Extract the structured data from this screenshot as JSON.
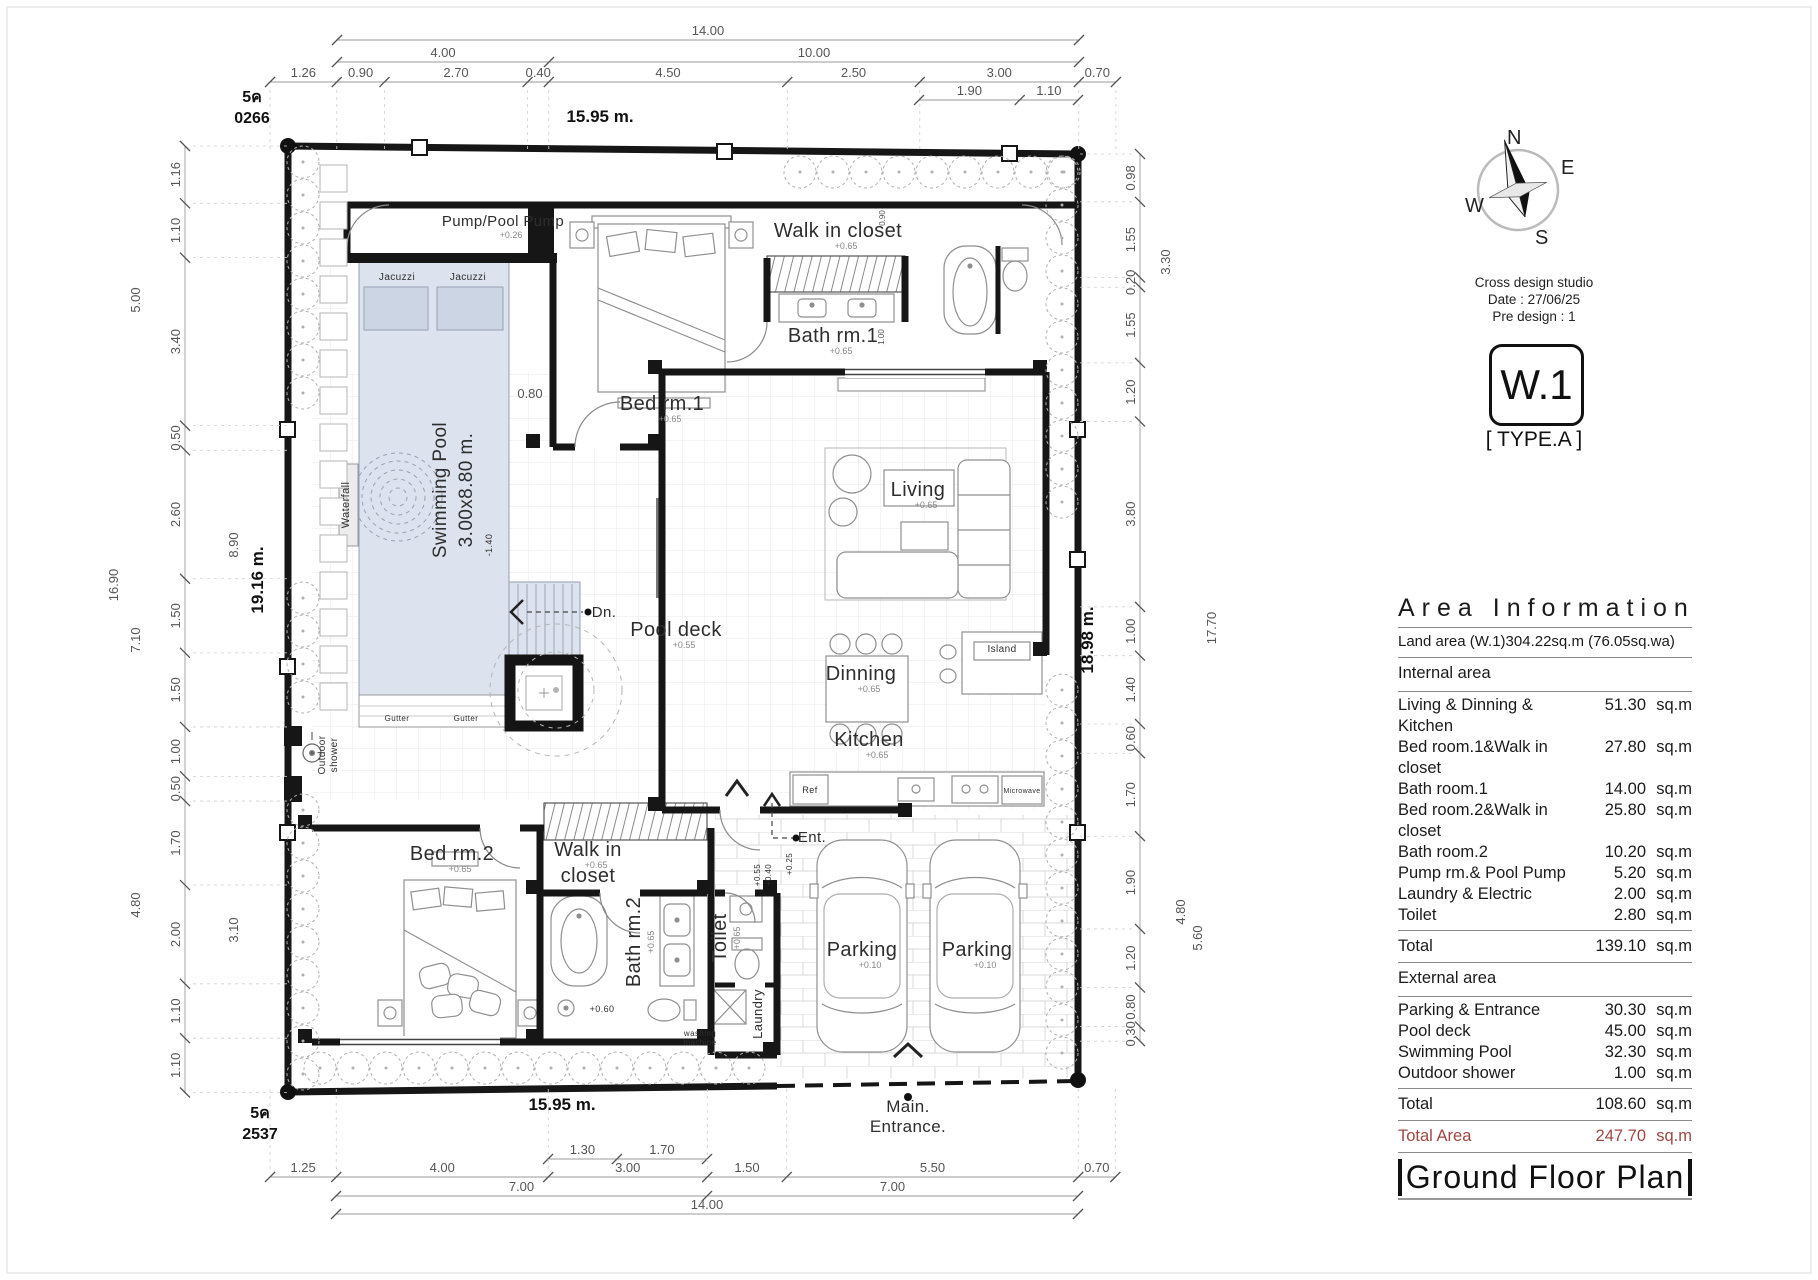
{
  "compass": {
    "n": "N",
    "e": "E",
    "s": "S",
    "w": "W"
  },
  "title_block": {
    "studio": "Cross design studio",
    "date_line": "Date : 27/06/25",
    "predesign_line": "Pre design : 1",
    "code": "W.1",
    "type_label": "[ TYPE.A ]"
  },
  "area_info": {
    "title": "Area Information",
    "land_line": "Land area (W.1)304.22sq.m (76.05sq.wa)",
    "internal_header": "Internal area",
    "internal_rows": [
      {
        "label": "Living & Dinning & Kitchen",
        "value": "51.30",
        "unit": "sq.m"
      },
      {
        "label": "Bed room.1&Walk in closet",
        "value": "27.80",
        "unit": "sq.m"
      },
      {
        "label": "Bath room.1",
        "value": "14.00",
        "unit": "sq.m"
      },
      {
        "label": "Bed room.2&Walk in closet",
        "value": "25.80",
        "unit": "sq.m"
      },
      {
        "label": "Bath room.2",
        "value": "10.20",
        "unit": "sq.m"
      },
      {
        "label": "Pump rm.& Pool Pump",
        "value": "5.20",
        "unit": "sq.m"
      },
      {
        "label": "Laundry & Electric",
        "value": "2.00",
        "unit": "sq.m"
      },
      {
        "label": "Toilet",
        "value": "2.80",
        "unit": "sq.m"
      }
    ],
    "internal_total": {
      "label": "Total",
      "value": "139.10",
      "unit": "sq.m"
    },
    "external_header": "External area",
    "external_rows": [
      {
        "label": "Parking & Entrance",
        "value": "30.30",
        "unit": "sq.m"
      },
      {
        "label": "Pool deck",
        "value": "45.00",
        "unit": "sq.m"
      },
      {
        "label": "Swimming Pool",
        "value": "32.30",
        "unit": "sq.m"
      },
      {
        "label": "Outdoor shower",
        "value": "1.00",
        "unit": "sq.m"
      }
    ],
    "external_total": {
      "label": "Total",
      "value": "108.60",
      "unit": "sq.m"
    },
    "grand_total": {
      "label": "Total Area",
      "value": "247.70",
      "unit": "sq.m"
    },
    "accent_color": "#9c4742",
    "plan_title": "Ground Floor Plan"
  },
  "plan": {
    "boundary_labels": [
      {
        "t": "15.95 m.",
        "x": 600,
        "y": 122
      },
      {
        "t": "15.95 m.",
        "x": 562,
        "y": 1110
      },
      {
        "t": "19.16 m.",
        "x": 263,
        "y": 580,
        "r": -90
      },
      {
        "t": "18.98 m.",
        "x": 1093,
        "y": 640,
        "r": -90
      }
    ],
    "corner_markers": [
      {
        "l1": "5ค",
        "l2": "0266",
        "x": 252,
        "y": 102
      },
      {
        "l1": "5ค",
        "l2": "2537",
        "x": 260,
        "y": 1118
      }
    ],
    "chains": {
      "sx": 53,
      "syl": 49.4,
      "syr": 48.8,
      "h": [
        {
          "y": 40,
          "x0": 337,
          "v": [
            "14.00"
          ]
        },
        {
          "y": 62,
          "x0": 337,
          "v": [
            "4.00",
            "10.00"
          ]
        },
        {
          "y": 82,
          "x0": 270,
          "v": [
            "1.26",
            "0.90",
            "2.70",
            "0.40",
            "4.50",
            "2.50",
            "3.00",
            "0.70"
          ],
          "ext": 150
        },
        {
          "y": 100,
          "x0": 919,
          "v": [
            "1.90",
            "1.10"
          ]
        },
        {
          "y": 1159,
          "x0": 548,
          "v": [
            "1.30",
            "1.70"
          ]
        },
        {
          "y": 1177,
          "x0": 270,
          "v": [
            "1.25",
            "4.00",
            "3.00",
            "1.50",
            "5.50",
            "0.70"
          ],
          "ext": 1085
        },
        {
          "y": 1196,
          "x0": 336,
          "v": [
            "7.00",
            "7.00"
          ]
        },
        {
          "y": 1214,
          "x0": 336,
          "v": [
            "14.00"
          ]
        }
      ],
      "vl": [
        {
          "x": 185,
          "y0": 146,
          "v": [
            "1.16",
            "1.10",
            "3.40",
            "0.50",
            "2.60",
            "1.50",
            "1.50",
            "1.00",
            "0.50",
            "1.70",
            "2.00",
            "1.10",
            "1.10"
          ],
          "ext": 288
        }
      ],
      "vr": [
        {
          "x": 1140,
          "y0": 154,
          "v": [
            "0.98",
            "1.55",
            "0.20",
            "1.55",
            "1.20",
            "3.80",
            "1.00",
            "1.40",
            "0.60",
            "1.70",
            "1.90",
            "1.20",
            "0.80",
            "0.30"
          ],
          "ext": 1078
        }
      ]
    },
    "extra_dims": [
      {
        "t": "5.00",
        "x": 140,
        "y": 300,
        "r": -90
      },
      {
        "t": "16.90",
        "x": 118,
        "y": 585,
        "r": -90
      },
      {
        "t": "7.10",
        "x": 140,
        "y": 640,
        "r": -90
      },
      {
        "t": "8.90",
        "x": 238,
        "y": 545,
        "r": -90
      },
      {
        "t": "4.80",
        "x": 140,
        "y": 905,
        "r": -90
      },
      {
        "t": "3.10",
        "x": 238,
        "y": 930,
        "r": -90
      },
      {
        "t": "17.70",
        "x": 1216,
        "y": 628,
        "r": -90
      },
      {
        "t": "3.30",
        "x": 1170,
        "y": 262,
        "r": -90
      },
      {
        "t": "4.80",
        "x": 1185,
        "y": 912,
        "r": -90
      },
      {
        "t": "5.60",
        "x": 1202,
        "y": 938,
        "r": -90
      },
      {
        "t": "0.80",
        "x": 530,
        "y": 398
      },
      {
        "t": "0.90",
        "x": 885,
        "y": 218,
        "r": -90,
        "s": 8
      },
      {
        "t": "1.00",
        "x": 884,
        "y": 337,
        "r": -90,
        "s": 8
      }
    ],
    "rooms": [
      {
        "t": "Pump/Pool Pump",
        "x": 503,
        "y": 226,
        "s": 15,
        "sub": "+0.26"
      },
      {
        "t": "Jacuzzi",
        "x": 397,
        "y": 280,
        "s": 10
      },
      {
        "t": "Jacuzzi",
        "x": 468,
        "y": 280,
        "s": 10
      },
      {
        "t": "Swimming Pool",
        "x": 446,
        "y": 490,
        "s": 19,
        "r": -90
      },
      {
        "t": "3.00x8.80 m.",
        "x": 472,
        "y": 490,
        "s": 19,
        "r": -90
      },
      {
        "t": "-1.40",
        "x": 492,
        "y": 545,
        "s": 9,
        "r": -90
      },
      {
        "t": "Waterfall",
        "x": 349,
        "y": 505,
        "s": 11,
        "r": -90
      },
      {
        "t": "Bed rm.1",
        "x": 662,
        "y": 410,
        "s": 20,
        "sub": "+0.65"
      },
      {
        "t": "Walk in closet",
        "x": 838,
        "y": 237,
        "s": 20,
        "sub": "+0.65"
      },
      {
        "t": "Bath rm.1",
        "x": 833,
        "y": 342,
        "s": 20,
        "sub": "+0.65"
      },
      {
        "t": "Living",
        "x": 918,
        "y": 496,
        "s": 20,
        "sub": "+0.65"
      },
      {
        "t": "Dinning",
        "x": 861,
        "y": 680,
        "s": 20,
        "sub": "+0.65"
      },
      {
        "t": "Kitchen",
        "x": 869,
        "y": 746,
        "s": 20,
        "sub": "+0.65"
      },
      {
        "t": "Island",
        "x": 1002,
        "y": 652,
        "s": 10
      },
      {
        "t": "Pool deck",
        "x": 676,
        "y": 636,
        "s": 20,
        "sub": "+0.55"
      },
      {
        "t": "Dn.",
        "x": 604,
        "y": 617,
        "s": 15
      },
      {
        "t": "Bed rm.2",
        "x": 452,
        "y": 860,
        "s": 20,
        "sub": "+0.65"
      },
      {
        "t": "Walk in",
        "x": 588,
        "y": 856,
        "s": 20,
        "sub": "+0.65"
      },
      {
        "t": "closet",
        "x": 588,
        "y": 882,
        "s": 20
      },
      {
        "t": "Bath rm.2",
        "x": 640,
        "y": 942,
        "s": 20,
        "r": -90,
        "sub": "+0.65"
      },
      {
        "t": "Toilet",
        "x": 726,
        "y": 938,
        "s": 20,
        "r": -90,
        "sub": "+0.65"
      },
      {
        "t": "Laundry",
        "x": 762,
        "y": 1014,
        "s": 13,
        "r": -90
      },
      {
        "t": "washing",
        "x": 700,
        "y": 1036,
        "s": 8
      },
      {
        "t": "machine",
        "x": 700,
        "y": 1045,
        "s": 8
      },
      {
        "t": "Parking",
        "x": 862,
        "y": 956,
        "s": 20,
        "sub": "+0.10"
      },
      {
        "t": "Parking",
        "x": 977,
        "y": 956,
        "s": 20,
        "sub": "+0.10"
      },
      {
        "t": "Ent.",
        "x": 812,
        "y": 842,
        "s": 15
      },
      {
        "t": "+0.25",
        "x": 792,
        "y": 864,
        "s": 8,
        "r": -90
      },
      {
        "t": "+0.55",
        "x": 760,
        "y": 875,
        "s": 8,
        "r": -90
      },
      {
        "t": "+0.40",
        "x": 771,
        "y": 875,
        "s": 8,
        "r": -90
      },
      {
        "t": "Main.",
        "x": 908,
        "y": 1112,
        "s": 17
      },
      {
        "t": "Entrance.",
        "x": 908,
        "y": 1132,
        "s": 17
      },
      {
        "t": "Gutter",
        "x": 397,
        "y": 721,
        "s": 8
      },
      {
        "t": "Gutter",
        "x": 466,
        "y": 721,
        "s": 8
      },
      {
        "t": "Outdoor",
        "x": 325,
        "y": 755,
        "s": 10,
        "r": -90
      },
      {
        "t": "shower",
        "x": 337,
        "y": 755,
        "s": 10,
        "r": -90
      },
      {
        "t": "+0.60",
        "x": 602,
        "y": 1012,
        "s": 9
      },
      {
        "t": "Ref",
        "x": 810,
        "y": 793,
        "s": 9
      },
      {
        "t": "Microwave",
        "x": 1022,
        "y": 793,
        "s": 7
      }
    ],
    "tree_runs": [
      {
        "axis": "x",
        "fixed": 172,
        "from": 800,
        "to": 1064,
        "step": 33
      },
      {
        "axis": "x",
        "fixed": 1068,
        "from": 320,
        "to": 752,
        "step": 33
      },
      {
        "axis": "y",
        "fixed": 303,
        "from": 162,
        "to": 395,
        "step": 33
      },
      {
        "axis": "y",
        "fixed": 303,
        "from": 598,
        "to": 698,
        "step": 33
      },
      {
        "axis": "y",
        "fixed": 303,
        "from": 810,
        "to": 1075,
        "step": 33
      },
      {
        "axis": "y",
        "fixed": 1062,
        "from": 172,
        "to": 503,
        "step": 33
      },
      {
        "axis": "y",
        "fixed": 1062,
        "from": 690,
        "to": 1054,
        "step": 33
      }
    ],
    "planters": {
      "x": 320,
      "from": 165,
      "to": 690,
      "step": 37,
      "size": 27
    }
  }
}
